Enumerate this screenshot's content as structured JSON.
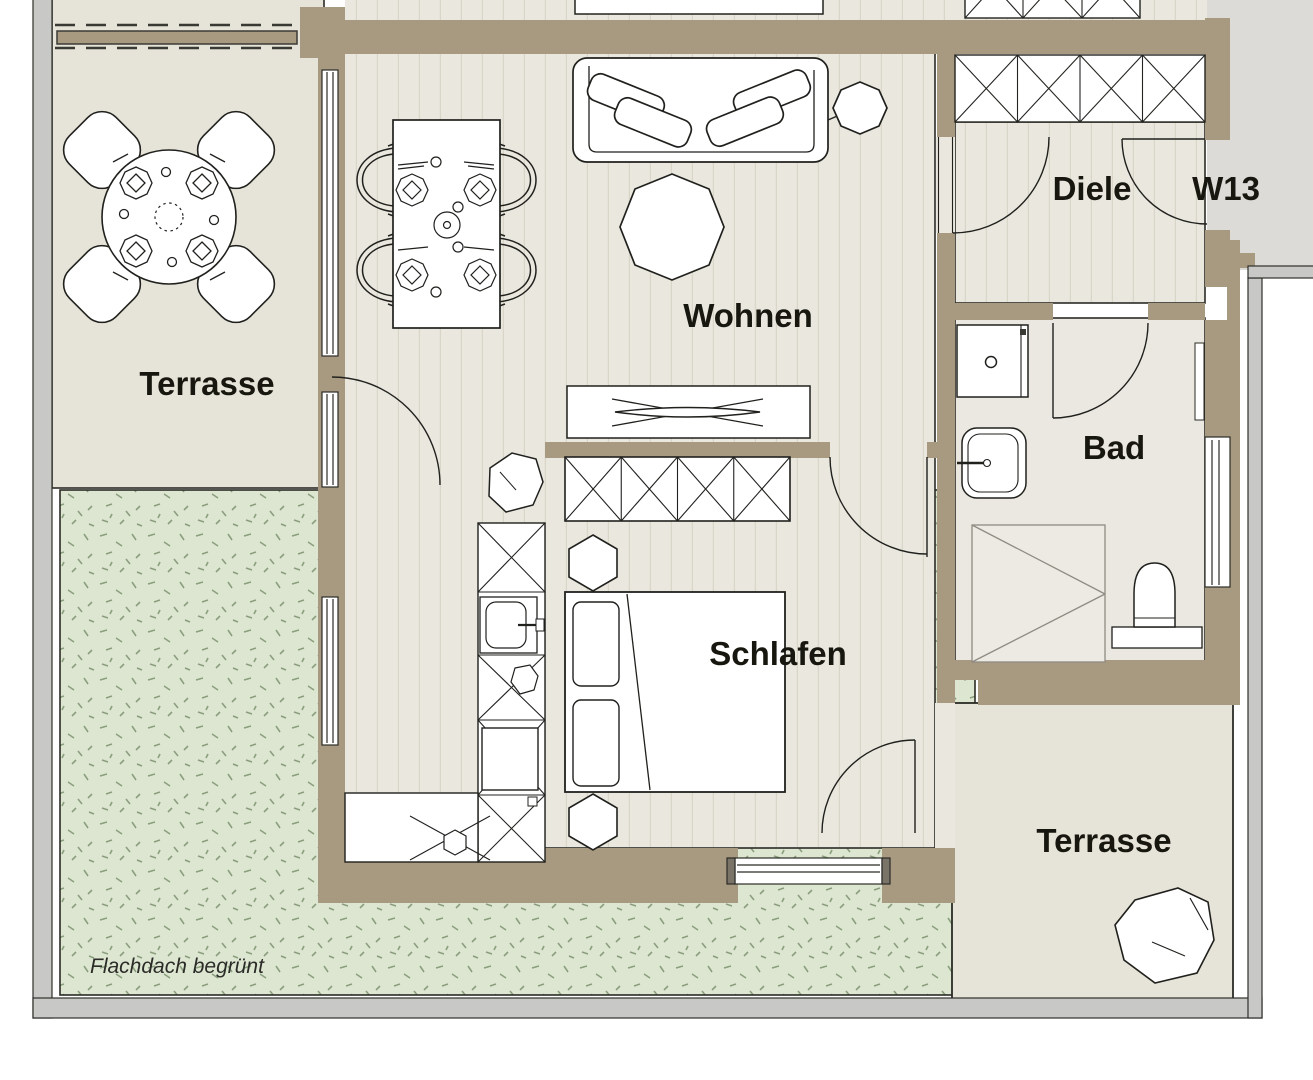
{
  "document": {
    "type": "architectural-floor-plan",
    "unit_label": "W13"
  },
  "labels": {
    "terrace_top": "Terrasse",
    "living": "Wohnen",
    "hall": "Diele",
    "unit": "W13",
    "bath": "Bad",
    "sleeping": "Schlafen",
    "terrace_bottom": "Terrasse",
    "roof": "Flachdach begrünt"
  },
  "colors": {
    "wall": "#a89a80",
    "floor": "#e9e7de",
    "plank": "#d9d6c8",
    "terrace": "#e6e3d8",
    "green": "#dce6d0",
    "grass": "#7d9370",
    "outside": "#dcdbd8",
    "parapet": "#c8c8c6",
    "line": "#2b2b26",
    "furn": "#ffffff",
    "ink": "#17170f"
  },
  "symbols": [
    "round-table",
    "terrace-chair",
    "place-setting",
    "dining-table",
    "dining-chair",
    "sofa",
    "cushion",
    "coffee-table",
    "side-table",
    "tv-lowboard",
    "wardrobe",
    "bed",
    "pillow",
    "nightstand",
    "kitchen-counter",
    "kitchen-sink",
    "oven",
    "cooktop",
    "washing-machine",
    "bath-sink",
    "shower",
    "toilet",
    "plant",
    "door-swing",
    "window",
    "pergola",
    "parapet",
    "green-roof"
  ]
}
